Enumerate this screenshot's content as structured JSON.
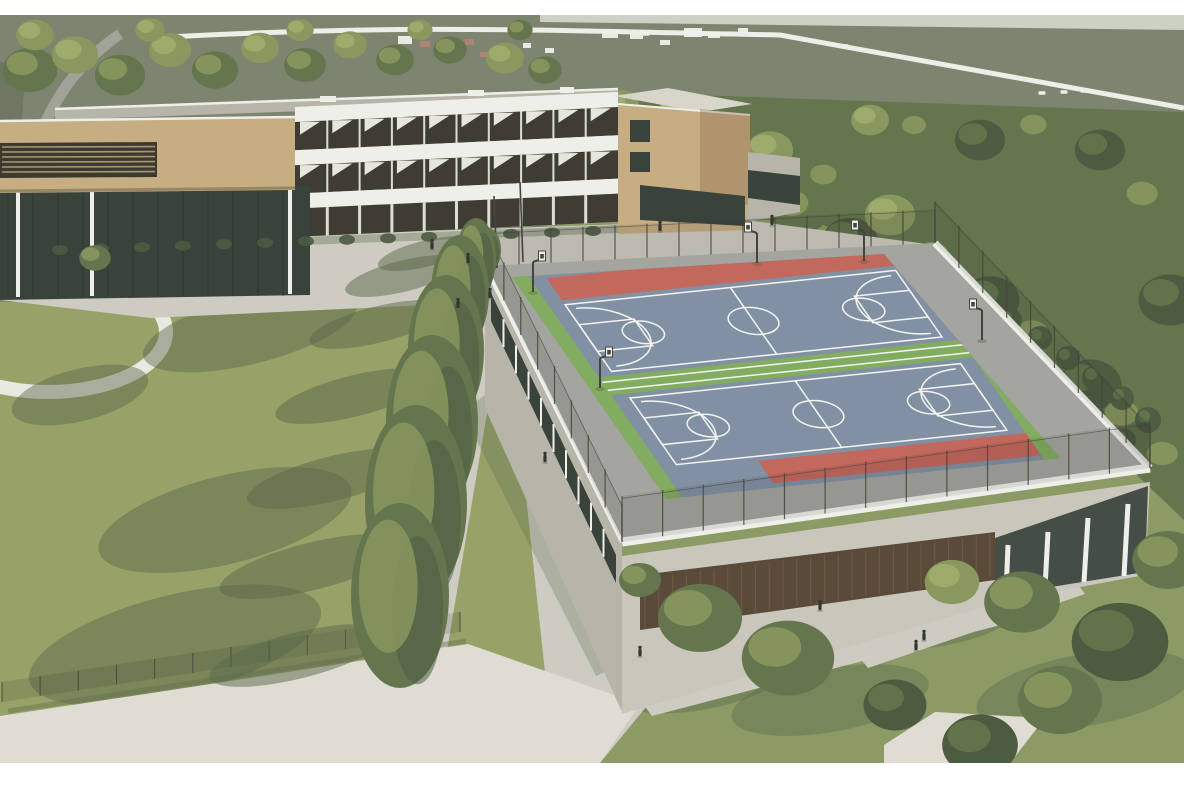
{
  "meta": {
    "title": "Aerial architectural rendering of a school campus with rooftop basketball courts",
    "type": "3d-render",
    "view": "aerial"
  },
  "colors": {
    "frame": "#ffffff",
    "haze": "#d9ddd3",
    "field": "#7d8571",
    "field_dark": "#6d7761",
    "road_gray": "#a5a69d",
    "road_white": "#eceee8",
    "white_struct": "#efefe9",
    "roof_red": "#b08476",
    "tree_dark": "#4d5b41",
    "tree_mid": "#65764e",
    "tree_light": "#88985f",
    "tree_bright": "#a0ae6f",
    "lawn": "#98a168",
    "shadow": "#59684a",
    "grass_right": "#8c9b66",
    "path": "#ceccc2",
    "path_bright": "#dedcd3",
    "walkway": "#a4a59e",
    "concrete": "#d8d5ca",
    "concrete_dark": "#b7b4a9",
    "facade_dark": "#3f3d33",
    "wood": "#c6ad82",
    "wood_dark": "#85684b",
    "louver": "#3c3a2e",
    "glass": "#39433c",
    "gym_wall": "#c9c6bc",
    "panel_brown": "#5a4a39",
    "court_blue": "#8290a3",
    "court_red": "#c3685d",
    "court_green": "#82ac60",
    "court_line": "#f3f5f2",
    "fence": "#45433d",
    "person": "#35352f"
  },
  "scene": {
    "village": [
      [
        398,
        36,
        14,
        8,
        0
      ],
      [
        420,
        41,
        10,
        6,
        1
      ],
      [
        442,
        44,
        12,
        7,
        0
      ],
      [
        465,
        39,
        9,
        6,
        1
      ],
      [
        500,
        47,
        12,
        7,
        0
      ],
      [
        523,
        43,
        8,
        5,
        0
      ],
      [
        602,
        30,
        16,
        8,
        0
      ],
      [
        630,
        33,
        13,
        6,
        0
      ],
      [
        684,
        28,
        18,
        9,
        0
      ],
      [
        708,
        32,
        12,
        6,
        0
      ],
      [
        738,
        28,
        10,
        5,
        0
      ],
      [
        480,
        52,
        8,
        5,
        1
      ],
      [
        545,
        48,
        9,
        5,
        0
      ],
      [
        660,
        40,
        10,
        5,
        0
      ]
    ],
    "cars": [
      [
        612,
        33
      ],
      [
        646,
        34
      ],
      [
        700,
        34
      ],
      [
        845,
        46
      ],
      [
        1042,
        93
      ],
      [
        1064,
        92
      ],
      [
        1084,
        91
      ],
      [
        357,
        30
      ]
    ],
    "canopies_bg": [
      [
        30,
        70,
        26,
        1
      ],
      [
        75,
        55,
        22,
        2
      ],
      [
        120,
        75,
        24,
        1
      ],
      [
        170,
        50,
        20,
        2
      ],
      [
        215,
        70,
        22,
        1
      ],
      [
        260,
        48,
        18,
        2
      ],
      [
        305,
        65,
        20,
        1
      ],
      [
        350,
        45,
        16,
        2
      ],
      [
        395,
        60,
        18,
        1
      ],
      [
        450,
        50,
        16,
        1
      ],
      [
        505,
        58,
        18,
        2
      ],
      [
        545,
        70,
        16,
        1
      ],
      [
        35,
        35,
        18,
        2
      ],
      [
        150,
        30,
        14,
        2
      ],
      [
        300,
        30,
        13,
        2
      ],
      [
        420,
        30,
        12,
        2
      ],
      [
        520,
        30,
        12,
        1
      ],
      [
        600,
        120,
        24,
        1
      ],
      [
        650,
        140,
        26,
        0
      ],
      [
        700,
        160,
        28,
        1
      ],
      [
        750,
        185,
        26,
        0
      ],
      [
        800,
        210,
        28,
        1
      ],
      [
        850,
        240,
        26,
        0
      ],
      [
        770,
        150,
        22,
        2
      ],
      [
        830,
        180,
        22,
        1
      ],
      [
        890,
        215,
        24,
        2
      ],
      [
        940,
        260,
        26,
        1
      ],
      [
        990,
        300,
        28,
        0
      ],
      [
        1040,
        340,
        28,
        1
      ],
      [
        1090,
        385,
        30,
        0
      ],
      [
        1130,
        420,
        28,
        1
      ],
      [
        1170,
        300,
        30,
        0
      ],
      [
        1150,
        200,
        26,
        1
      ],
      [
        1100,
        150,
        24,
        0
      ],
      [
        1040,
        130,
        22,
        1
      ],
      [
        980,
        140,
        24,
        0
      ],
      [
        920,
        130,
        20,
        1
      ],
      [
        870,
        120,
        18,
        2
      ],
      [
        1170,
        460,
        26,
        1
      ],
      [
        620,
        105,
        18,
        2
      ],
      [
        680,
        110,
        20,
        2
      ]
    ],
    "canopies_fg": [
      [
        95,
        258,
        15,
        1
      ],
      [
        700,
        618,
        40,
        1
      ],
      [
        788,
        658,
        44,
        1
      ],
      [
        952,
        582,
        26,
        2
      ],
      [
        1022,
        602,
        36,
        1
      ],
      [
        1120,
        642,
        46,
        0
      ],
      [
        1168,
        560,
        34,
        1
      ],
      [
        895,
        705,
        30,
        0
      ],
      [
        1060,
        700,
        40,
        1
      ],
      [
        980,
        745,
        36,
        0
      ],
      [
        640,
        580,
        20,
        1
      ]
    ],
    "garden_bushes": [
      [
        940,
        300,
        10
      ],
      [
        975,
        308,
        11
      ],
      [
        1010,
        320,
        12
      ],
      [
        1040,
        338,
        12
      ],
      [
        1068,
        358,
        12
      ],
      [
        1095,
        378,
        13
      ],
      [
        1122,
        398,
        12
      ],
      [
        1148,
        420,
        13
      ],
      [
        955,
        335,
        9
      ],
      [
        990,
        350,
        10
      ],
      [
        1025,
        370,
        11
      ],
      [
        1058,
        392,
        11
      ],
      [
        1092,
        415,
        12
      ],
      [
        925,
        315,
        8
      ],
      [
        1010,
        398,
        9
      ],
      [
        1045,
        420,
        10
      ],
      [
        1125,
        440,
        11
      ]
    ],
    "base_bushes_count": 14,
    "conifers": [
      [
        488,
        272,
        26,
        44
      ],
      [
        476,
        298,
        40,
        80
      ],
      [
        460,
        350,
        58,
        115
      ],
      [
        446,
        425,
        76,
        150
      ],
      [
        432,
        510,
        92,
        175
      ],
      [
        416,
        600,
        102,
        195
      ],
      [
        400,
        688,
        98,
        185
      ]
    ],
    "lawn_shadows": [
      [
        250,
        330,
        110,
        34
      ],
      [
        225,
        520,
        130,
        44
      ],
      [
        175,
        645,
        150,
        50
      ],
      [
        80,
        395,
        70,
        26
      ]
    ],
    "grass_shadows": [
      [
        700,
        680,
        90,
        30
      ],
      [
        830,
        700,
        100,
        32
      ],
      [
        1085,
        690,
        110,
        36
      ],
      [
        940,
        620,
        80,
        26
      ]
    ],
    "facade": {
      "bays": 10,
      "x1": 295,
      "x2": 618,
      "y_top_left": 107,
      "y_top_right": 92,
      "floor_h": 43.3,
      "spandrel_h": 15,
      "floors": 3,
      "fin_floors": 2
    },
    "gym_slats": 26,
    "left_wall_mullions": 9,
    "atrium_mullions": 12,
    "louver_lines": 6,
    "platform_fences": [
      [
        487,
        266,
        935,
        243,
        14,
        34
      ],
      [
        935,
        243,
        1150,
        468,
        9,
        42
      ],
      [
        487,
        266,
        622,
        542,
        8,
        38
      ],
      [
        622,
        542,
        1150,
        468,
        13,
        46
      ]
    ],
    "ground_fence": [
      2,
      702,
      460,
      632,
      12,
      20
    ],
    "hoops": [
      [
        533,
        292,
        1
      ],
      [
        600,
        388,
        1
      ],
      [
        757,
        263,
        -1
      ],
      [
        864,
        261,
        -1
      ],
      [
        982,
        340,
        -1
      ]
    ],
    "people": [
      [
        458,
        308
      ],
      [
        545,
        462
      ],
      [
        640,
        656
      ],
      [
        924,
        640
      ],
      [
        916,
        650
      ],
      [
        432,
        249
      ],
      [
        468,
        263
      ],
      [
        490,
        298
      ],
      [
        660,
        231
      ],
      [
        772,
        225
      ],
      [
        820,
        610
      ]
    ],
    "stair_steps": 5
  }
}
